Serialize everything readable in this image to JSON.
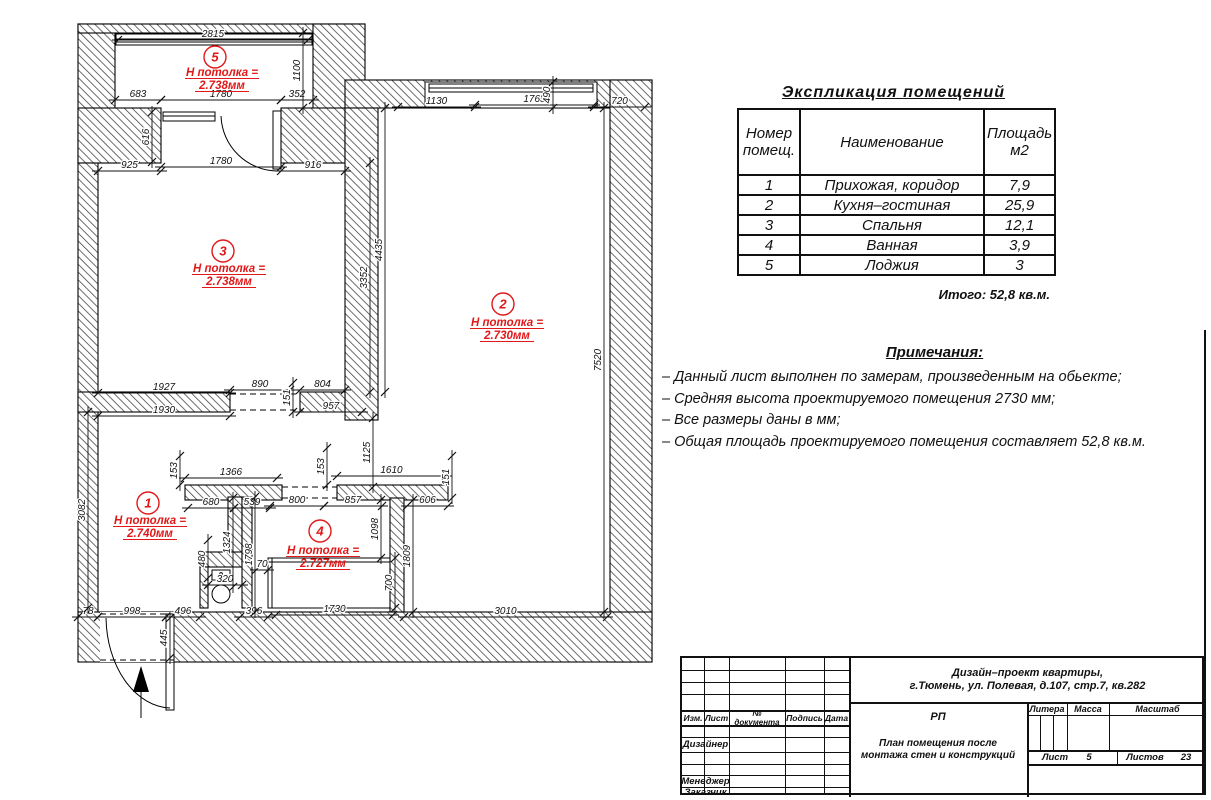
{
  "explication": {
    "title": "Экспликация помещений",
    "columns": [
      "Номер помещ.",
      "Наименование",
      "Площадь м2"
    ],
    "rows": [
      {
        "num": "1",
        "name": "Прихожая,  коридор",
        "area": "7,9"
      },
      {
        "num": "2",
        "name": "Кухня–гостиная",
        "area": "25,9"
      },
      {
        "num": "3",
        "name": "Спальня",
        "area": "12,1"
      },
      {
        "num": "4",
        "name": "Ванная",
        "area": "3,9"
      },
      {
        "num": "5",
        "name": "Лоджия",
        "area": "3"
      }
    ],
    "total": "Итого:  52,8  кв.м."
  },
  "notes": {
    "title": "Примечания:",
    "items": [
      "–  Данный лист выполнен по замерам, произведенным на обьекте;",
      "–  Средняя высота проектируемого помещения 2730 мм;",
      "–  Все размеры даны в мм;",
      "–  Общая площадь проектируемого помещения составляет   52,8  кв.м."
    ]
  },
  "title_block": {
    "project_line1": "Дизайн–проект квартиры,",
    "project_line2": "г.Тюмень,  ул.  Полевая,  д.107,  стр.7,  кв.282",
    "stage": "РП",
    "doc_title_line1": "План помещения после",
    "doc_title_line2": "монтажа стен и конструкций",
    "col_izm": "Изм.",
    "col_list": "Лист",
    "col_doc": "№ документа",
    "col_sign": "Подпись",
    "col_date": "Дата",
    "role_designer": "Дизайнер",
    "role_manager": "Менеджер",
    "role_client": "Заказчик",
    "litera": "Литера",
    "massa": "Масса",
    "masshtab": "Масштаб",
    "sheet_label": "Лист",
    "sheet_value": "5",
    "sheets_label": "Листов",
    "sheets_value": "23"
  },
  "plan": {
    "red": "#e01818",
    "rooms": [
      {
        "num": "5",
        "cx": 215,
        "cy": 57,
        "tx": 222,
        "ty": 76,
        "label": "Н потолка =",
        "value": "2.738мм"
      },
      {
        "num": "3",
        "cx": 223,
        "cy": 251,
        "tx": 229,
        "ty": 272,
        "label": "Н потолка =",
        "value": "2.738мм"
      },
      {
        "num": "2",
        "cx": 503,
        "cy": 304,
        "tx": 507,
        "ty": 326,
        "label": "Н потолка =",
        "value": "2.730мм"
      },
      {
        "num": "1",
        "cx": 148,
        "cy": 503,
        "tx": 150,
        "ty": 524,
        "label": "Н потолка =",
        "value": "2.740мм"
      },
      {
        "num": "4",
        "cx": 320,
        "cy": 531,
        "tx": 323,
        "ty": 554,
        "label": "Н потолка =",
        "value": "2.727мм"
      }
    ],
    "dims_h": [
      [
        "2815",
        118,
        308,
        40
      ],
      [
        "683",
        115,
        161,
        100
      ],
      [
        "1780",
        161,
        281,
        100
      ],
      [
        "352",
        281,
        313,
        100
      ],
      [
        "925",
        98,
        161,
        171
      ],
      [
        "1780",
        161,
        281,
        167
      ],
      [
        "916",
        281,
        345,
        171
      ],
      [
        "1130",
        398,
        475,
        107
      ],
      [
        "1765",
        475,
        594,
        105
      ],
      [
        "720",
        594,
        645,
        107
      ],
      [
        "1927",
        98,
        230,
        393
      ],
      [
        "890",
        230,
        290,
        390
      ],
      [
        "804",
        300,
        345,
        390
      ],
      [
        "1930",
        98,
        230,
        416
      ],
      [
        "957",
        300,
        362,
        412
      ],
      [
        "1366",
        185,
        277,
        478
      ],
      [
        "1610",
        337,
        446,
        476
      ],
      [
        "680",
        188,
        234,
        508
      ],
      [
        "539",
        234,
        270,
        508
      ],
      [
        "800",
        270,
        324,
        506
      ],
      [
        "857",
        324,
        382,
        506
      ],
      [
        "606",
        407,
        448,
        506
      ],
      [
        "70",
        256,
        268,
        570
      ],
      [
        "320",
        208,
        242,
        585
      ],
      [
        "78",
        78,
        98,
        617
      ],
      [
        "998",
        98,
        166,
        617
      ],
      [
        "496",
        166,
        200,
        617
      ],
      [
        "396",
        240,
        268,
        617
      ],
      [
        "1730",
        276,
        393,
        615
      ],
      [
        "3010",
        404,
        607,
        617
      ]
    ],
    "dims_v": [
      [
        "1100",
        33,
        108,
        303
      ],
      [
        "490",
        82,
        108,
        553
      ],
      [
        "616",
        112,
        162,
        152
      ],
      [
        "3352",
        163,
        392,
        370
      ],
      [
        "4435",
        108,
        392,
        385
      ],
      [
        "7520",
        108,
        612,
        604
      ],
      [
        "151",
        383,
        412,
        293
      ],
      [
        "1125",
        418,
        487,
        373
      ],
      [
        "153",
        456,
        485,
        180
      ],
      [
        "153",
        448,
        485,
        327
      ],
      [
        "151",
        456,
        498,
        452
      ],
      [
        "3082",
        412,
        608,
        88
      ],
      [
        "1324",
        498,
        587,
        233
      ],
      [
        "1798",
        497,
        612,
        255
      ],
      [
        "480",
        540,
        578,
        208
      ],
      [
        "1098",
        500,
        558,
        381
      ],
      [
        "700",
        558,
        608,
        395
      ],
      [
        "1809",
        500,
        612,
        413
      ],
      [
        "445",
        618,
        658,
        170
      ]
    ]
  }
}
